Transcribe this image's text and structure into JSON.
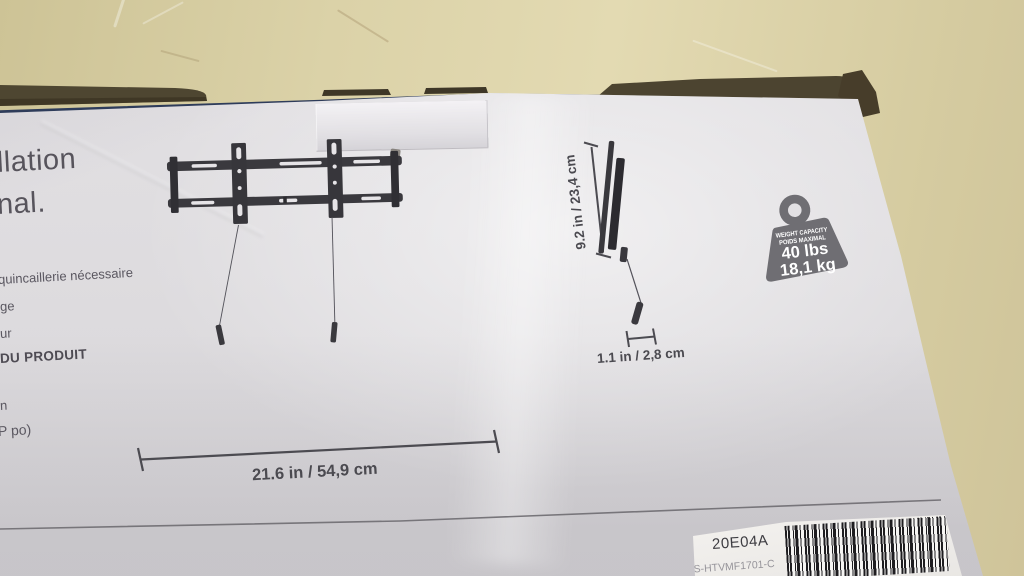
{
  "colors": {
    "table_surface": "#d9cfa6",
    "dark_background": "#2a1a13",
    "box_face": "#e1dfe2",
    "box_edge_line": "#2e3c5a",
    "cardboard_flap": "#4d4531",
    "drawing_ink": "#3a393e",
    "panel_text": "#5a5760",
    "badge_fill": "#6f6e73",
    "badge_text": "#ffffff",
    "sticker_bg": "#f1efec",
    "barcode_ink": "#1e1d20"
  },
  "panel": {
    "headline_line1": "llation",
    "headline_line2": "nal.",
    "list_line1": "quincaillerie nécessaire",
    "list_line2": "ge",
    "list_line3": "ur",
    "heading": "DU PRODUIT",
    "spec_line1": "n",
    "spec_line2": "P po)"
  },
  "drawing": {
    "width_label": "21.6 in / 54,9 cm",
    "height_label": "9.2 in / 23,4 cm",
    "depth_label": "1.1 in / 2,8 cm"
  },
  "weight_badge": {
    "title_line1": "WEIGHT CAPACITY",
    "title_line2": "POIDS MAXIMAL",
    "capacity_lbs": "40 lbs",
    "capacity_kg": "18,1 kg"
  },
  "sticker": {
    "batch_code": "20E04A",
    "model_number": "NS-HTVMF1701-C"
  }
}
